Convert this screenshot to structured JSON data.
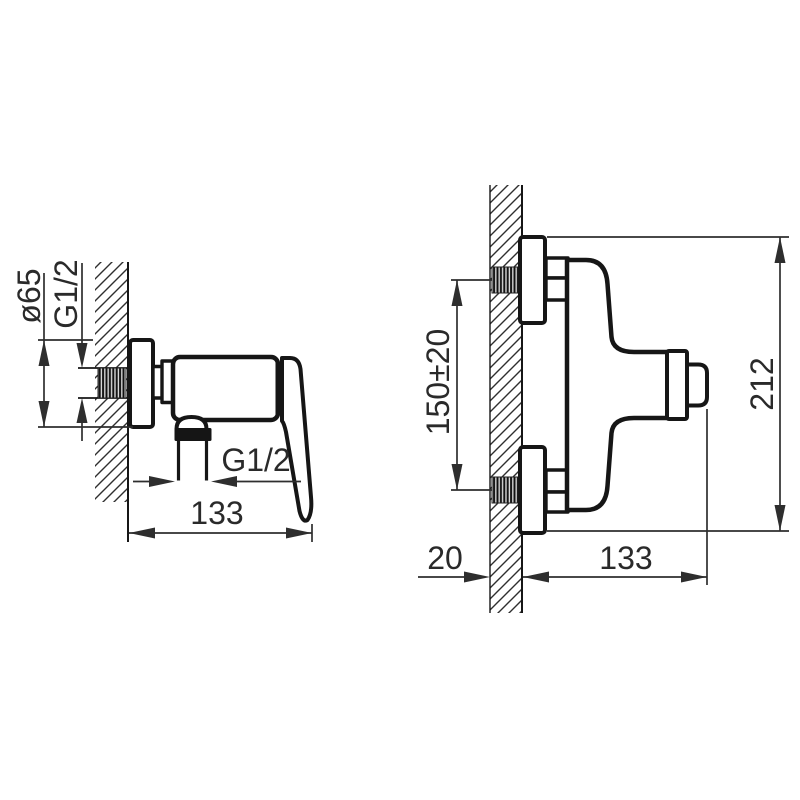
{
  "drawing": {
    "title": "Wall-mounted shower mixer - dimensional technical drawing",
    "colors": {
      "background": "#ffffff",
      "object_line": "#161616",
      "dimension_line": "#2e2e2e",
      "text": "#2a2a2a",
      "seal_black": "#151515"
    },
    "views": {
      "side": {
        "name": "side-view",
        "labels": {
          "flange_diameter": "ø65",
          "wall_inlet_thread": "G1/2",
          "outlet_thread": "G1/2",
          "wall_to_handle_depth": "133"
        }
      },
      "front": {
        "name": "front-view",
        "labels": {
          "connection_spacing": "150±20",
          "overall_height": "212",
          "wall_thickness": "20",
          "wall_to_knob_depth": "133"
        }
      }
    }
  }
}
